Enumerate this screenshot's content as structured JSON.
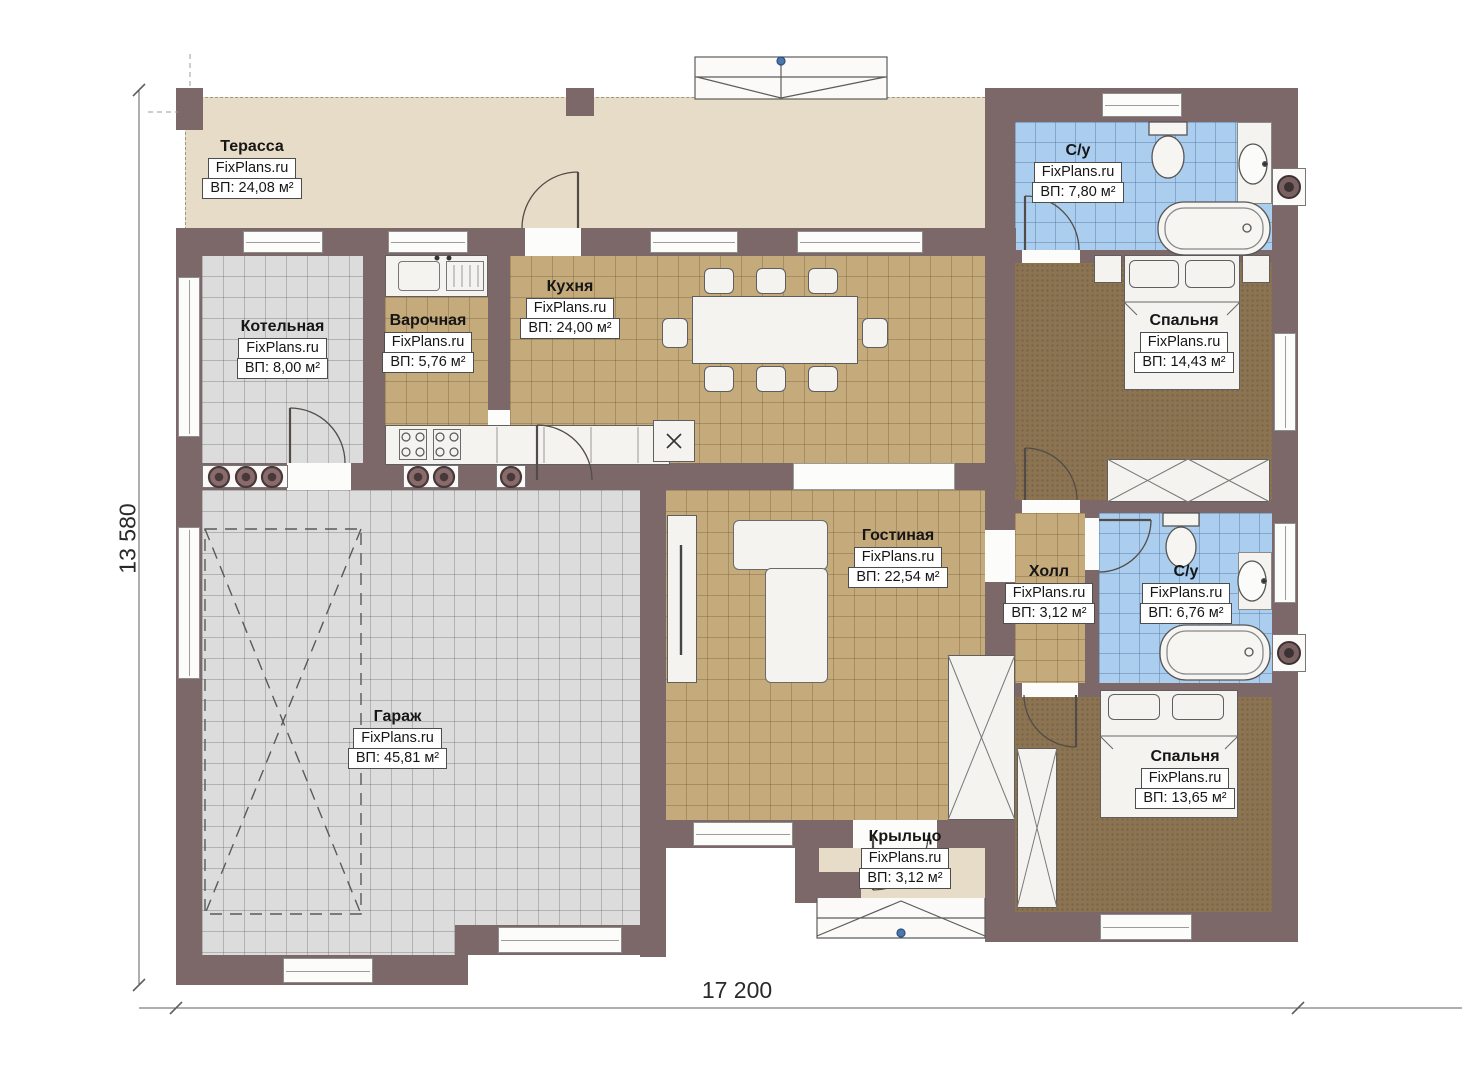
{
  "plan": {
    "watermark": "FixPlans.ru",
    "dimensions": {
      "width_label": "17 200",
      "height_label": "13 580"
    },
    "rooms": [
      {
        "id": "terrace",
        "name": "Терасса",
        "area": "ВП: 24,08 м²"
      },
      {
        "id": "boiler",
        "name": "Котельная",
        "area": "ВП: 8,00 м²"
      },
      {
        "id": "cooking",
        "name": "Варочная",
        "area": "ВП: 5,76 м²"
      },
      {
        "id": "kitchen",
        "name": "Кухня",
        "area": "ВП: 24,00 м²"
      },
      {
        "id": "bath1",
        "name": "С/у",
        "area": "ВП: 7,80 м²"
      },
      {
        "id": "bedroom1",
        "name": "Спальня",
        "area": "ВП: 14,43 м²"
      },
      {
        "id": "living",
        "name": "Гостиная",
        "area": "ВП: 22,54 м²"
      },
      {
        "id": "hall",
        "name": "Холл",
        "area": "ВП: 3,12 м²"
      },
      {
        "id": "bath2",
        "name": "С/у",
        "area": "ВП: 6,76 м²"
      },
      {
        "id": "garage",
        "name": "Гараж",
        "area": "ВП: 45,81 м²"
      },
      {
        "id": "bedroom2",
        "name": "Спальня",
        "area": "ВП: 13,65 м²"
      },
      {
        "id": "porch",
        "name": "Крыльцо",
        "area": "ВП: 3,12 м²"
      }
    ],
    "colors": {
      "wall": "#7c6869",
      "terrace_floor": "#e7dcc7",
      "tile_tan": "#c5aa7c",
      "tile_gray": "#dcdcdc",
      "tile_blue": "#abceef",
      "floor_brown": "#8c7452",
      "fixture": "#f4f3f0",
      "marker_blue": "#4a77ad"
    }
  }
}
